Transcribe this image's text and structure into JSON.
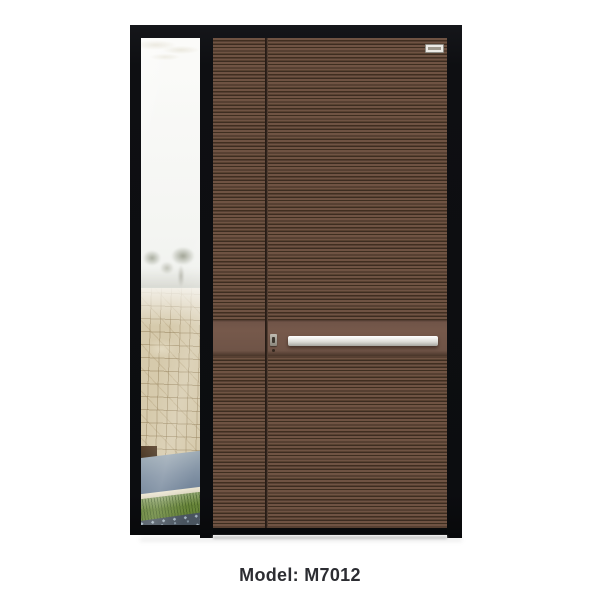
{
  "page": {
    "background_color": "#ffffff",
    "caption": {
      "model_label": "Model: M7012"
    }
  },
  "product": {
    "type": "entry-door-with-left-sidelight",
    "brand_plate": {
      "present": true,
      "label": ""
    }
  },
  "colors": {
    "frame_black": "#0e0f12",
    "door_brown_base": "#6f5343",
    "door_rib_dark": "#3a2b22",
    "smooth_band_brown": "#76594b",
    "handle_steel_light": "#f1f1ee",
    "handle_steel_dark": "#a6a69f",
    "caption_text": "#2c2d32",
    "stone_wall": "#d6caac",
    "sky": "#f4f5f2",
    "path_grey_blue": "#8494a6",
    "grass_green": "#688539",
    "gravel_grey": "#49545f"
  },
  "scene_layers": [
    "sky",
    "palm-frond",
    "trees",
    "stone-wall",
    "planter-box",
    "path",
    "curb",
    "grass",
    "gravel",
    "glass-reflection"
  ]
}
